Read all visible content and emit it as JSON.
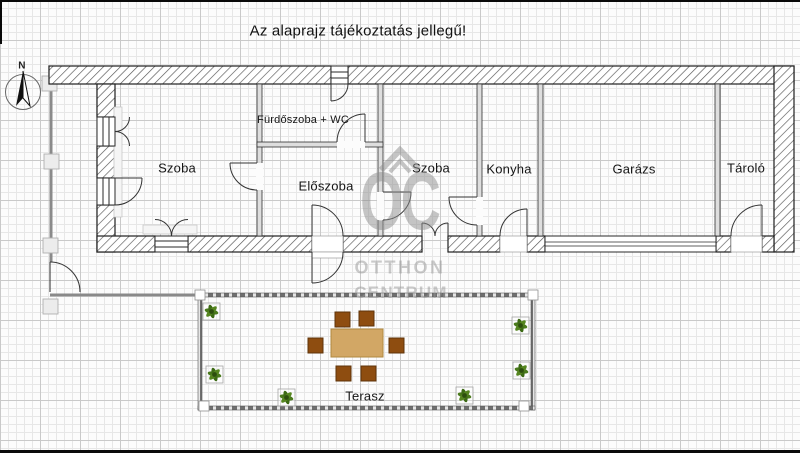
{
  "title": "Az alaprajz tájékoztatás jellegű!",
  "compass": {
    "north_label": "N"
  },
  "rooms": {
    "szoba1": "Szoba",
    "furdoszoba": "Fürdőszoba + WC",
    "eloszoba": "Előszoba",
    "szoba2": "Szoba",
    "konyha": "Konyha",
    "garazs": "Garázs",
    "tarolo": "Tároló",
    "terasz": "Terasz"
  },
  "watermark": {
    "monogram": "OC",
    "brand_line1": "OTTHON",
    "brand_line2": "CENTRUM"
  },
  "colors": {
    "wall_line": "#1f1f1f",
    "hatch": "#555555",
    "partition_fill": "#dedede",
    "fence_gray": "#8a8a8a",
    "table_fill": "#d2a765",
    "chair_fill": "#8e4d10",
    "plant_green": "#4a7a1c",
    "watermark_gray": "#8d8d8d"
  }
}
